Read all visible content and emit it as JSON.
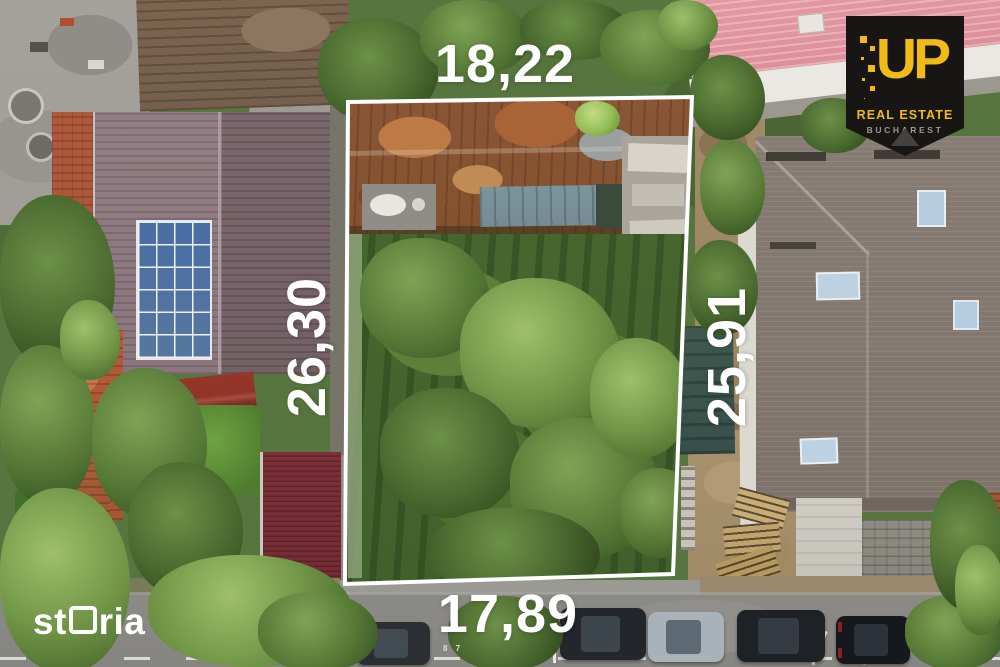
{
  "overlay": {
    "plot_dimensions": {
      "top": "18,22",
      "left": "26,30",
      "right": "25,91",
      "bottom": "17,89"
    },
    "boundary_color": "#ffffff",
    "label_color": "#ffffff"
  },
  "branding": {
    "storia": {
      "part1": "st",
      "part2": "ria",
      "full_text": "storia",
      "color": "#ffffff"
    },
    "up": {
      "brand": "UP",
      "tagline": "REAL ESTATE",
      "city": "BUCHAREST",
      "accent_color": "#f1ba17",
      "background_color": "#171614",
      "city_color": "#9d9a92"
    }
  },
  "road": {
    "stall_number": "8 7"
  }
}
